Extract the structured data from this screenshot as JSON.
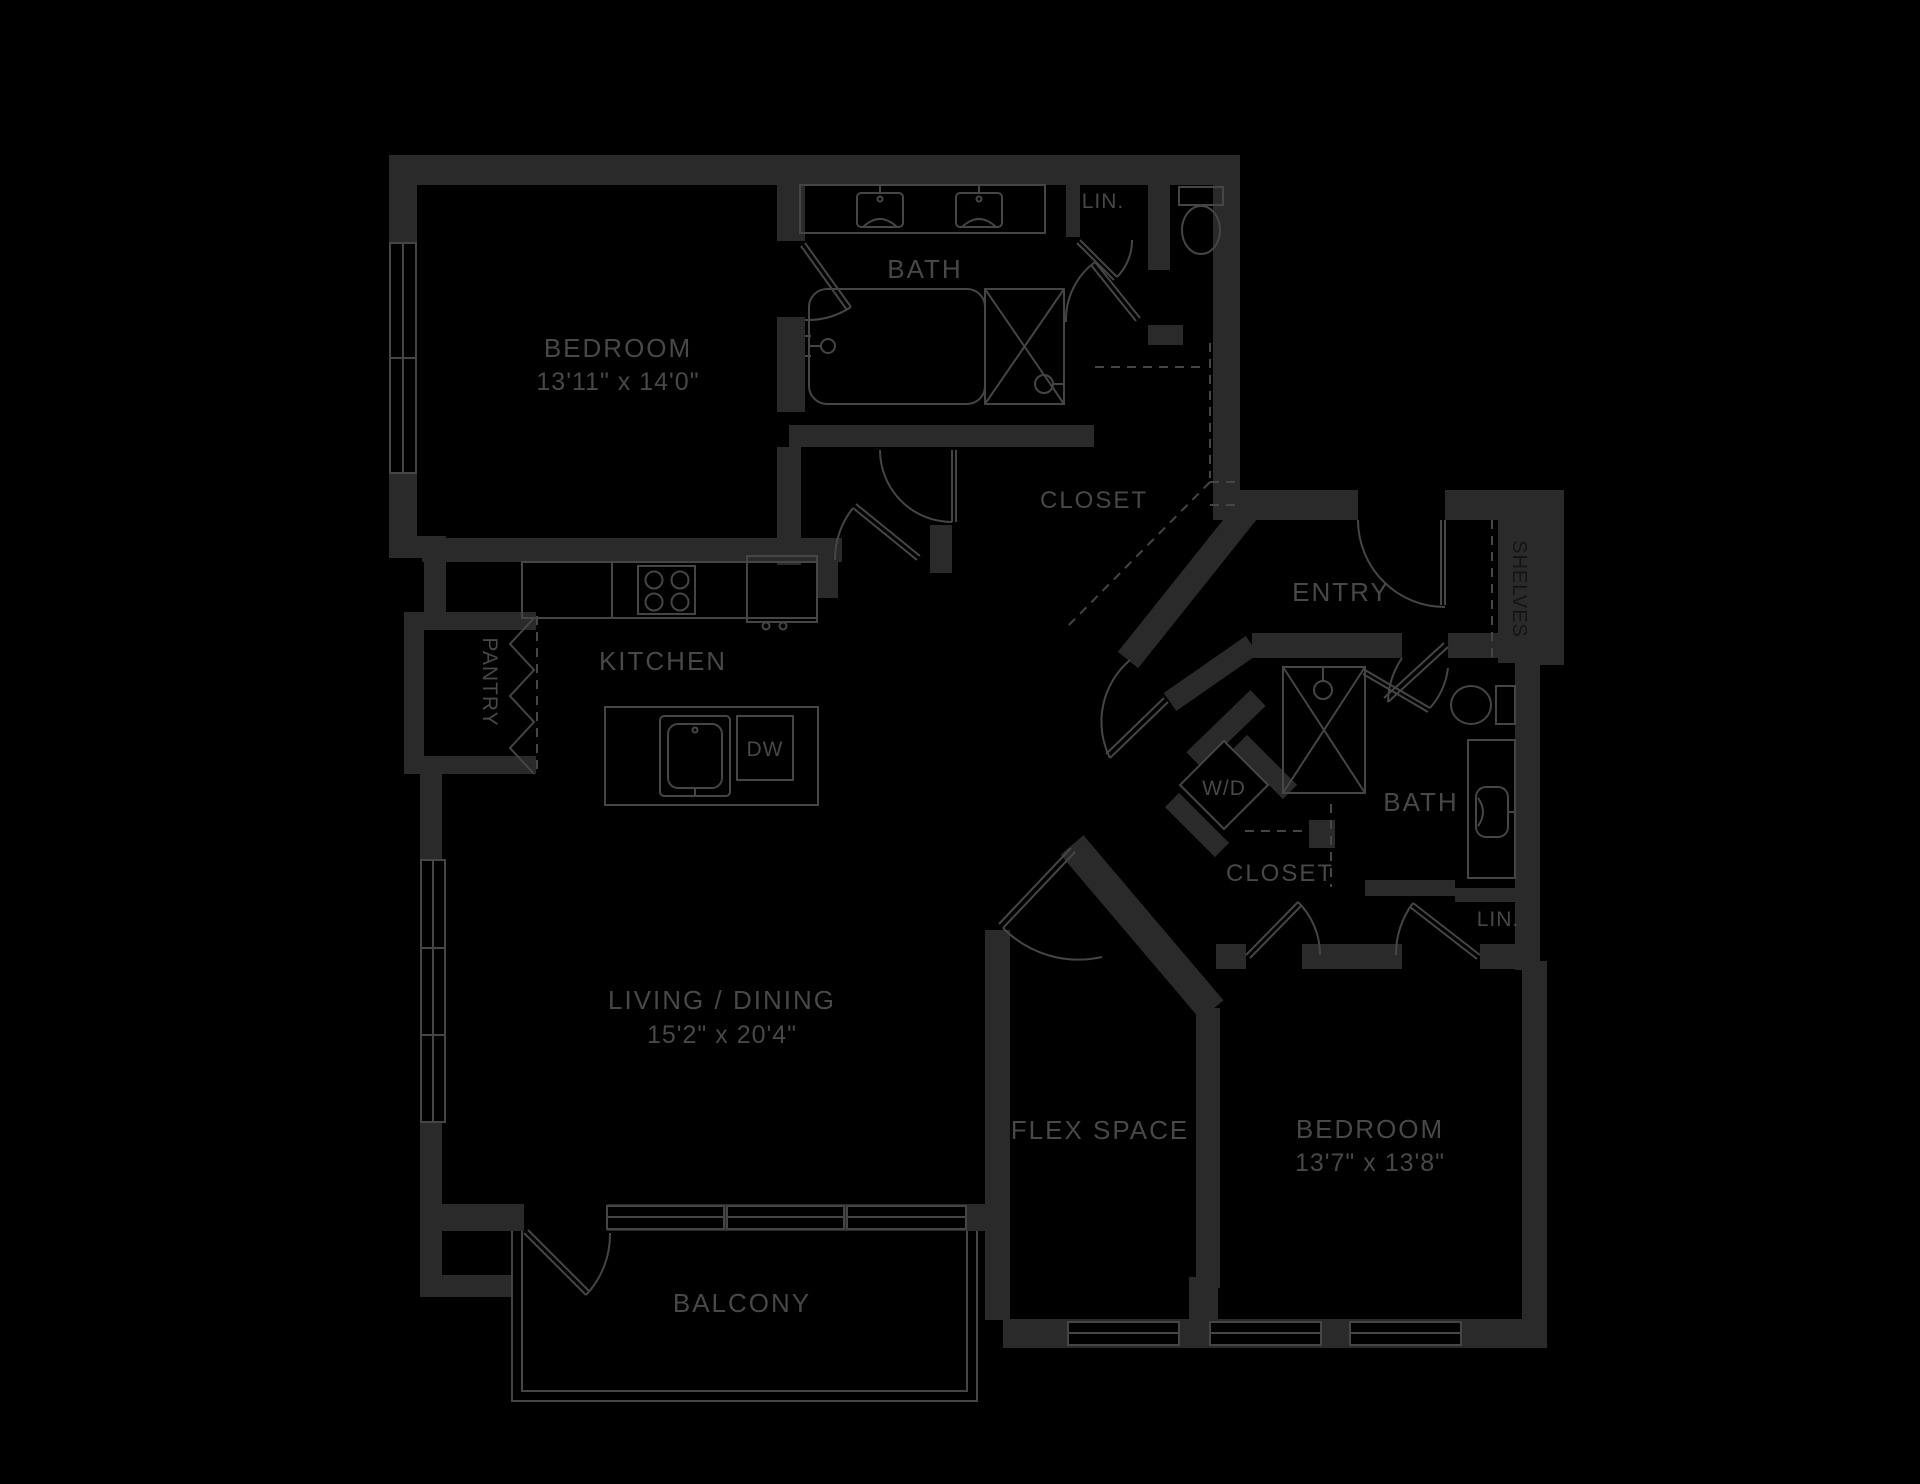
{
  "plan": {
    "type": "apartment-floor-plan",
    "theme": {
      "background": "#000000",
      "wall_color": "#2a2a2a",
      "line_color": "#454545",
      "label_color": "#484848",
      "inverse_label_color": "#141414"
    },
    "rooms": {
      "bedroom1": {
        "label": "BEDROOM",
        "dims": "13'11\" x 14'0\""
      },
      "bath1": {
        "label": "BATH"
      },
      "lin1": {
        "label": "LIN."
      },
      "closet1": {
        "label": "CLOSET"
      },
      "entry": {
        "label": "ENTRY"
      },
      "shelves": {
        "label": "SHELVES"
      },
      "pantry": {
        "label": "PANTRY"
      },
      "kitchen": {
        "label": "KITCHEN"
      },
      "dishwasher": {
        "label": "DW"
      },
      "living": {
        "label": "LIVING / DINING",
        "dims": "15'2\" x 20'4\""
      },
      "balcony": {
        "label": "BALCONY"
      },
      "flex": {
        "label": "FLEX SPACE"
      },
      "bedroom2": {
        "label": "BEDROOM",
        "dims": "13'7\" x 13'8\""
      },
      "washer_dryer": {
        "label": "W/D"
      },
      "bath2": {
        "label": "BATH"
      },
      "closet2": {
        "label": "CLOSET"
      },
      "lin2": {
        "label": "LIN."
      }
    }
  }
}
